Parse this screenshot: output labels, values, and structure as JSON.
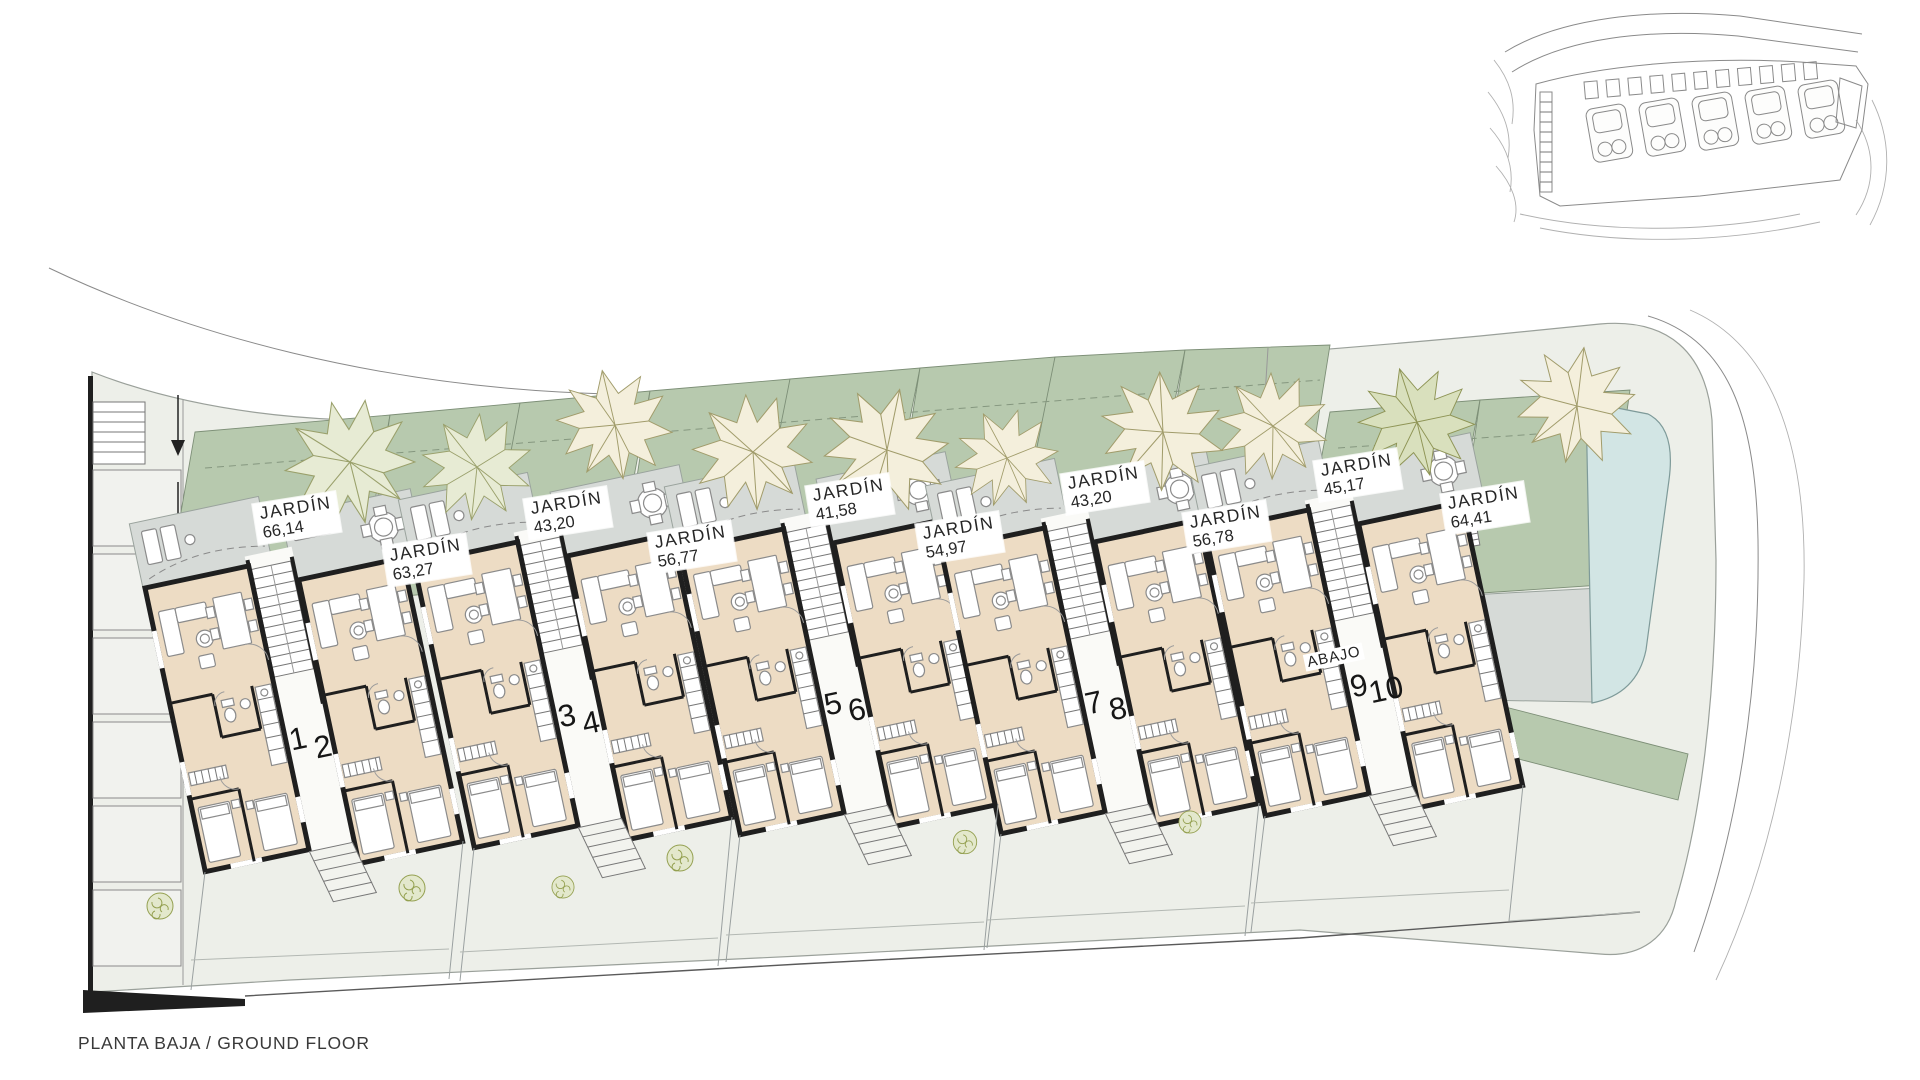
{
  "title": "PLANTA BAJA / GROUND FLOOR",
  "abajo_label": "ABAJO",
  "gardens": [
    {
      "name": "JARDÍN",
      "area": "66,14"
    },
    {
      "name": "JARDÍN",
      "area": "63,27"
    },
    {
      "name": "JARDÍN",
      "area": "43,20"
    },
    {
      "name": "JARDÍN",
      "area": "56,77"
    },
    {
      "name": "JARDÍN",
      "area": "41,58"
    },
    {
      "name": "JARDÍN",
      "area": "54,97"
    },
    {
      "name": "JARDÍN",
      "area": "43,20"
    },
    {
      "name": "JARDÍN",
      "area": "56,78"
    },
    {
      "name": "JARDÍN",
      "area": "45,17"
    },
    {
      "name": "JARDÍN",
      "area": "64,41"
    }
  ],
  "units": [
    "1",
    "2",
    "3",
    "4",
    "5",
    "6",
    "7",
    "8",
    "9",
    "10"
  ],
  "colors": {
    "garden": "#b7c9ae",
    "terrace": "#d6dad7",
    "interior": "#eddcc4",
    "wall": "#1f1f1f",
    "pool": "#d2e5e4",
    "ground": "#edefe9",
    "tree_cream": "#f4efdc",
    "tree_olive": "#d9e0bd"
  }
}
